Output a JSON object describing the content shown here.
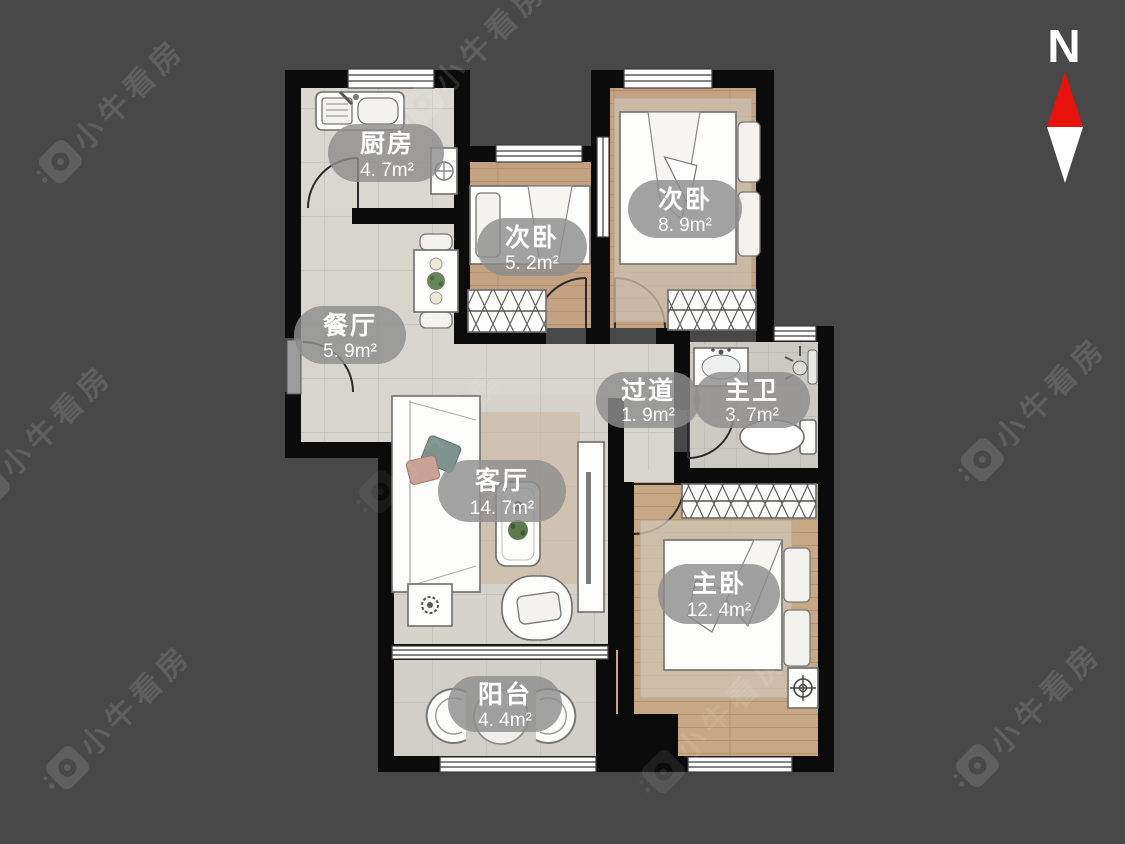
{
  "canvas": {
    "background": "#484848",
    "wall_color": "#0b0b0b"
  },
  "compass": {
    "label": "N",
    "north_color": "#e8120c",
    "south_color": "#ffffff"
  },
  "watermark": {
    "text": "小牛看房"
  },
  "rooms": [
    {
      "id": "kitchen",
      "name": "厨房",
      "area": "4. 7m²"
    },
    {
      "id": "bedroom-small",
      "name": "次卧",
      "area": "5. 2m²"
    },
    {
      "id": "bedroom-second",
      "name": "次卧",
      "area": "8. 9m²"
    },
    {
      "id": "dining",
      "name": "餐厅",
      "area": "5. 9m²"
    },
    {
      "id": "hallway",
      "name": "过道",
      "area": "1. 9m²"
    },
    {
      "id": "master-bath",
      "name": "主卫",
      "area": "3. 7m²"
    },
    {
      "id": "living",
      "name": "客厅",
      "area": "14. 7m²"
    },
    {
      "id": "master-bedroom",
      "name": "主卧",
      "area": "12. 4m²"
    },
    {
      "id": "balcony",
      "name": "阳台",
      "area": "4. 4m²"
    }
  ]
}
